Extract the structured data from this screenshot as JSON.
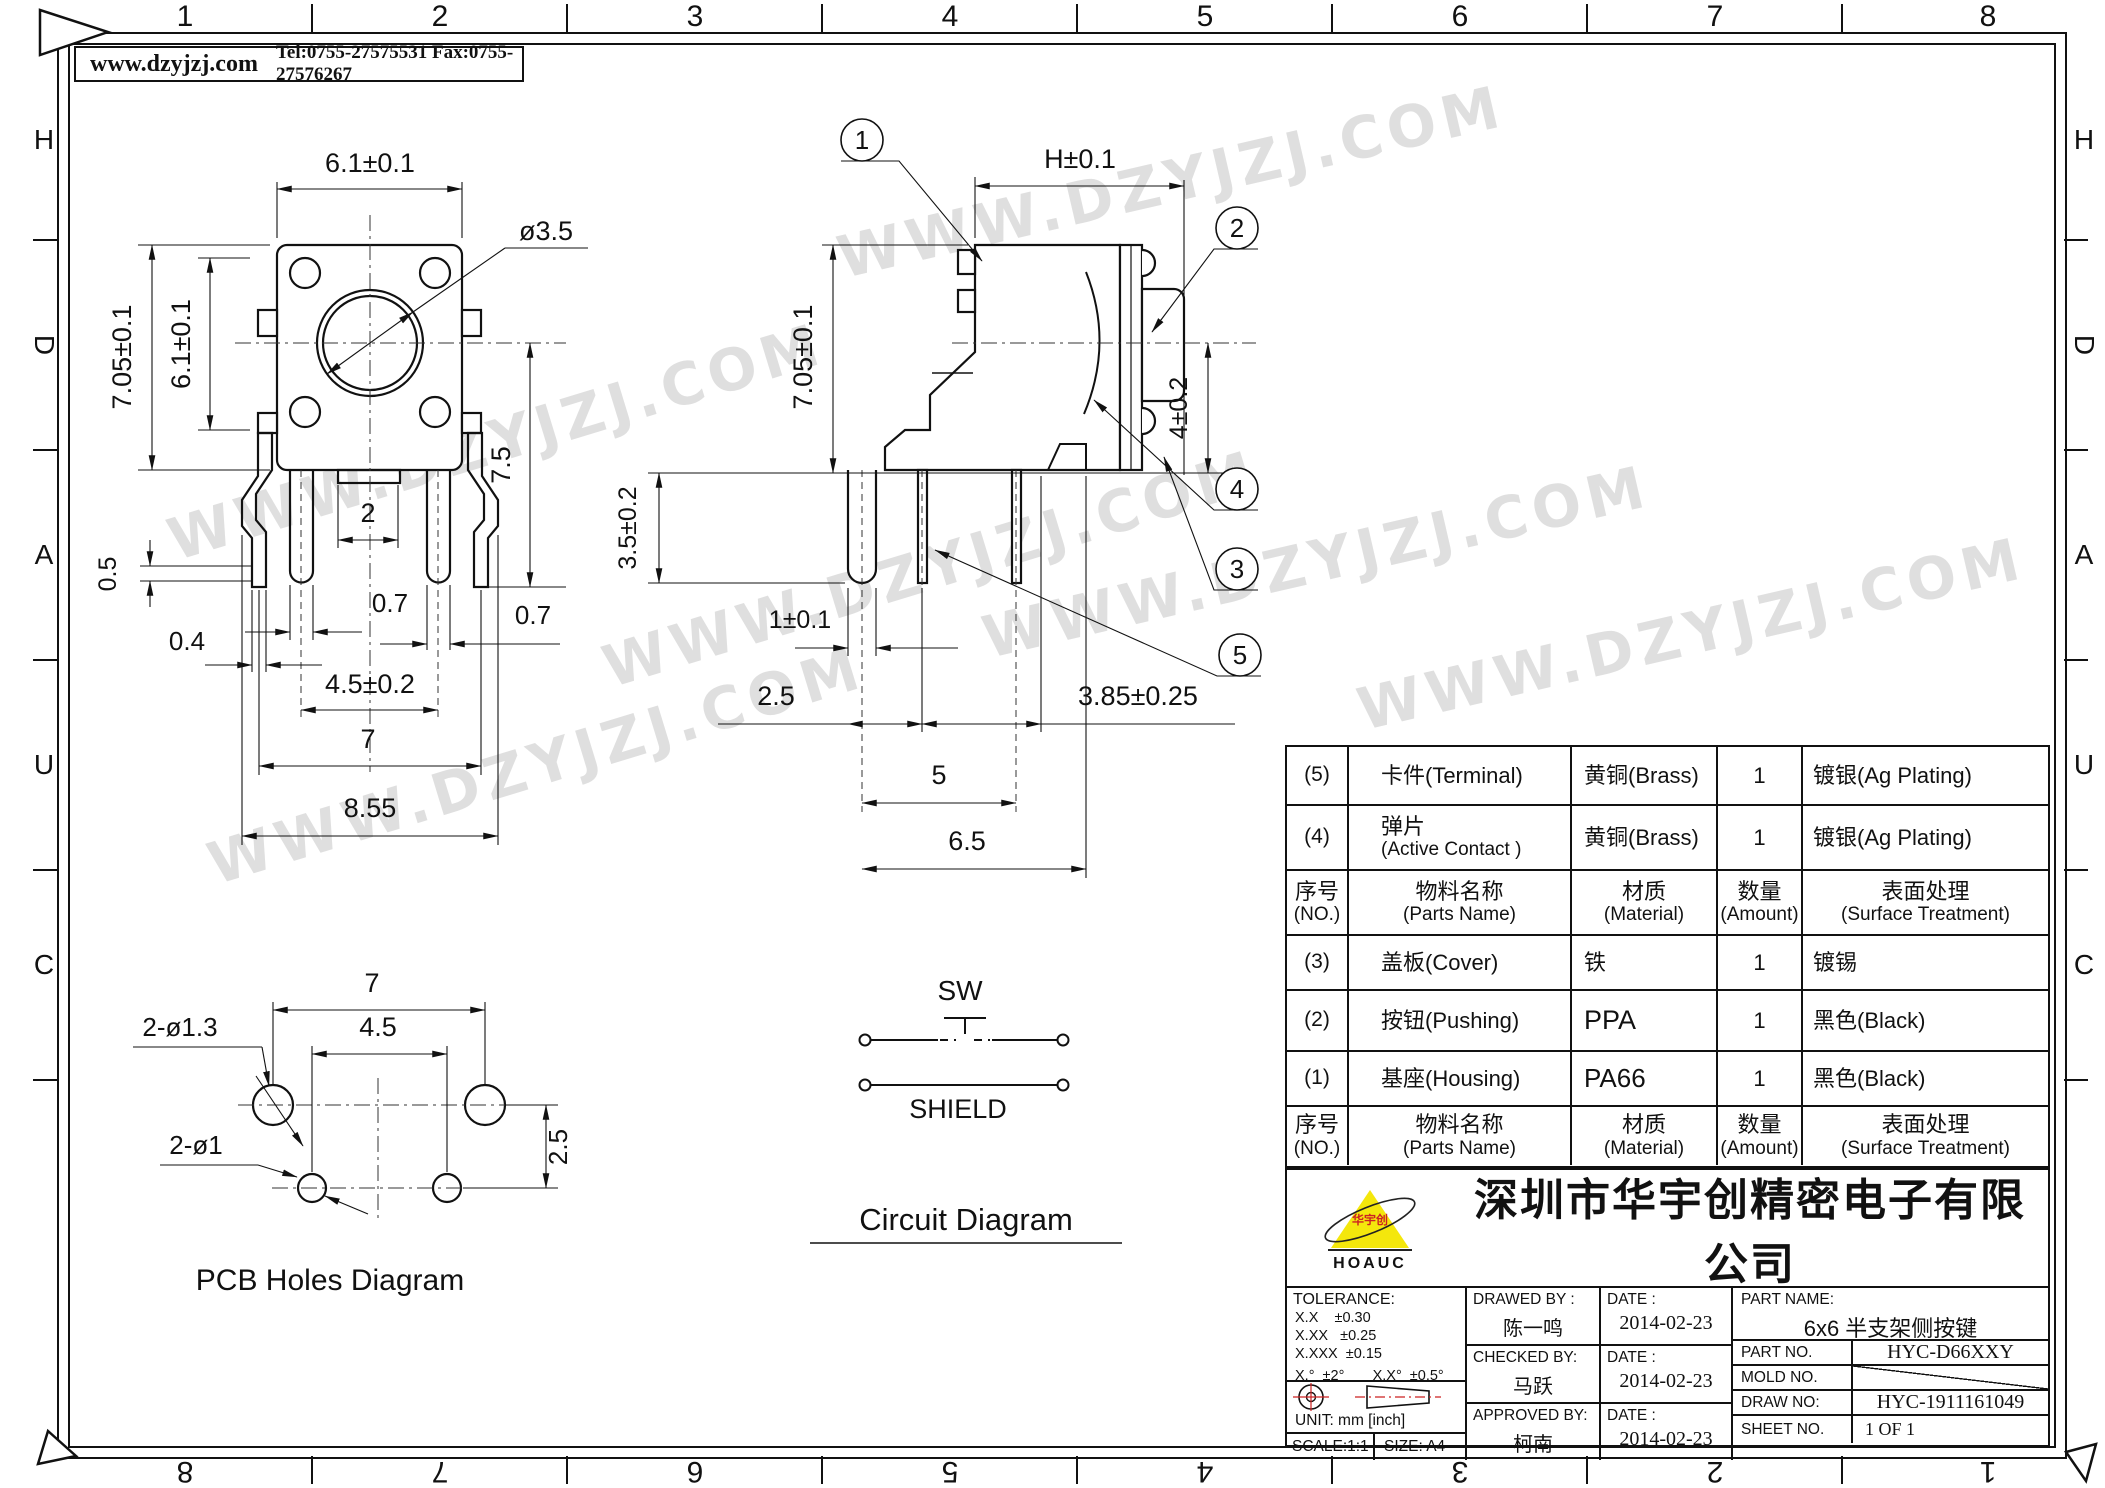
{
  "watermark": {
    "text": "WWW.DZYJZJ.COM"
  },
  "header": {
    "site": "www.dzyjzj.com",
    "contact": "Tel:0755-27575531  Fax:0755-27576267"
  },
  "border": {
    "top_numbers": [
      "1",
      "2",
      "3",
      "4",
      "5",
      "6",
      "7",
      "8"
    ],
    "bottom_numbers": [
      "8",
      "7",
      "6",
      "5",
      "4",
      "3",
      "2",
      "1"
    ],
    "left_letters": [
      "H",
      "D",
      "A",
      "U",
      "C"
    ],
    "right_letters": [
      "H",
      "D",
      "A",
      "U",
      "C"
    ]
  },
  "front_view": {
    "dims": {
      "top_width": "6.1±0.1",
      "outer_height": "7.05±0.1",
      "inner_height": "6.1±0.1",
      "hole": "ø3.5",
      "leg_len": "7.5",
      "pin_gap": "2",
      "offset": "0.5",
      "pin_w_left": "0.7",
      "pin_w_right": "0.7",
      "bracket_w": "0.4",
      "pin_pitch": "4.5±0.2",
      "bracket_pitch": "7",
      "total_w": "8.55"
    }
  },
  "side_view": {
    "dims": {
      "h": "H±0.1",
      "body_h": "7.05±0.1",
      "leg_len": "3.5±0.2",
      "button": "4±0.2",
      "pin_w": "1±0.1",
      "d25": "2.5",
      "d385": "3.85±0.25",
      "d5": "5",
      "d65": "6.5"
    },
    "callouts": {
      "c1": "1",
      "c2": "2",
      "c3": "3",
      "c4": "4",
      "c5": "5"
    }
  },
  "pcb_view": {
    "title": "PCB Holes Diagram",
    "dims": {
      "d7": "7",
      "d45": "4.5",
      "d25": "2.5",
      "holes_large": "2-ø1.3",
      "holes_small": "2-ø1"
    }
  },
  "circuit": {
    "sw_label": "SW",
    "shield_label": "SHIELD",
    "title": "Circuit Diagram"
  },
  "bom": {
    "rows": [
      {
        "no": "(5)",
        "name": "卡件(Terminal)",
        "name2": "",
        "mat": "黄铜(Brass)",
        "qty": "1",
        "surf": "镀银(Ag Plating)"
      },
      {
        "no": "(4)",
        "name": "弹片",
        "name2": "(Active Contact )",
        "mat": "黄铜(Brass)",
        "qty": "1",
        "surf": "镀银(Ag Plating)"
      },
      {
        "no": "序号",
        "no2": "(NO.)",
        "name": "物料名称",
        "name2": "(Parts Name)",
        "mat": "材质",
        "mat2": "(Material)",
        "qty": "数量",
        "qty2": "(Amount)",
        "surf": "表面处理",
        "surf2": "(Surface Treatment)"
      },
      {
        "no": "(3)",
        "name": "盖板(Cover)",
        "name2": "",
        "mat": "铁",
        "qty": "1",
        "surf": "镀锡"
      },
      {
        "no": "(2)",
        "name": "按钮(Pushing)",
        "name2": "",
        "mat": "PPA",
        "qty": "1",
        "surf": "黑色(Black)"
      },
      {
        "no": "(1)",
        "name": "基座(Housing)",
        "name2": "",
        "mat": "PA66",
        "qty": "1",
        "surf": "黑色(Black)"
      },
      {
        "no": "序号",
        "no2": "(NO.)",
        "name": "物料名称",
        "name2": "(Parts Name)",
        "mat": "材质",
        "mat2": "(Material)",
        "qty": "数量",
        "q2": "",
        "qty2": "(Amount)",
        "surf": "表面处理",
        "surf2": "(Surface Treatment)"
      }
    ]
  },
  "title_block": {
    "company": "深圳市华宇创精密电子有限公司",
    "logo_text": "HOAUC",
    "logo_cn": "华宇创",
    "tolerance_label": "TOLERANCE:",
    "tol_1": "X.X    ±0.30",
    "tol_2": "X.XX   ±0.25",
    "tol_3": "X.XXX  ±0.15",
    "tol_angle": "X.°  ±2°       X.X°  ±0.5°",
    "unit": "UNIT:  mm  [inch]",
    "scale": "SCALE:1:1",
    "size": "SIZE:  A4",
    "drawed_label": "DRAWED  BY :",
    "drawed_name": "陈一鸣",
    "drawed_date_label": "DATE :",
    "drawed_date": "2014-02-23",
    "checked_label": "CHECKED  BY:",
    "checked_name": "马跃",
    "checked_date_label": "DATE :",
    "checked_date": "2014-02-23",
    "approved_label": "APPROVED  BY:",
    "approved_name": "柯南",
    "approved_date_label": "DATE :",
    "approved_date": "2014-02-23",
    "part_name_label": "PART  NAME:",
    "part_name": "6x6  半支架侧按键",
    "part_no_label": "PART  NO.",
    "part_no": "HYC-D66XXY",
    "mold_no_label": "MOLD  NO.",
    "draw_no_label": "DRAW  NO:",
    "draw_no": "HYC-1911161049",
    "sheet_no_label": "SHEET  NO.",
    "sheet_no": "1 OF 1"
  }
}
